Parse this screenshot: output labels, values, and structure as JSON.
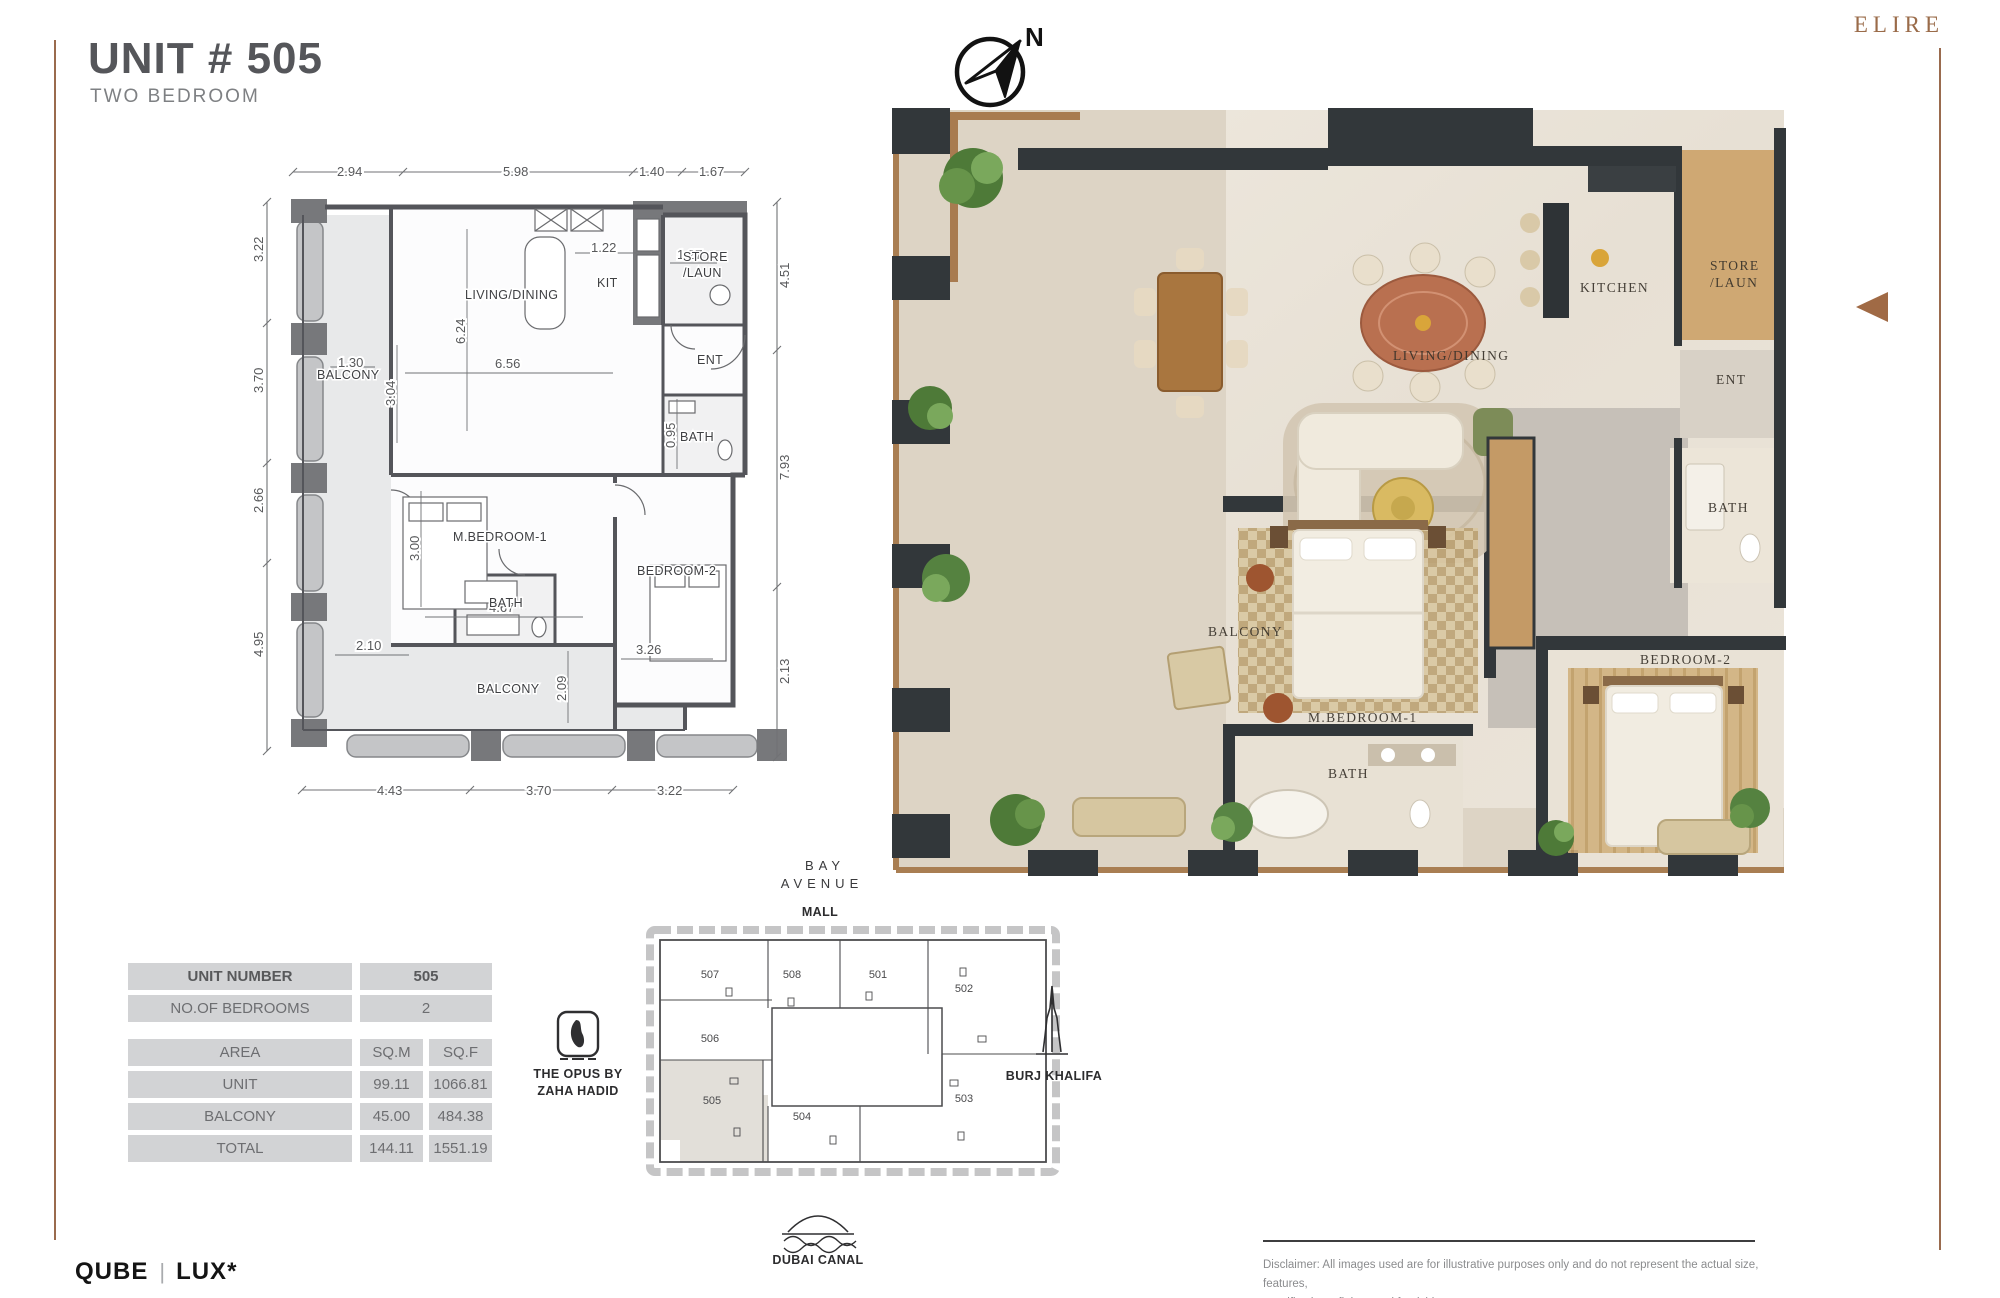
{
  "header": {
    "title": "UNIT # 505",
    "subtitle": "TWO BEDROOM",
    "brand": "ELIRE"
  },
  "compass": {
    "label": "N"
  },
  "plan": {
    "labels": {
      "balcony_top": "BALCONY",
      "living": "LIVING/DINING",
      "kit": "KIT",
      "store_l1": "STORE",
      "store_l2": "/LAUN",
      "ent": "ENT",
      "bath_top": "BATH",
      "mbed": "M.BEDROOM-1",
      "bed2": "BEDROOM-2",
      "bath_low": "BATH",
      "balcony_bottom": "BALCONY"
    },
    "dims": {
      "top": [
        "2.94",
        "5.98",
        "1.40",
        "1.67"
      ],
      "left": [
        "3.22",
        "3.70",
        "2.66",
        "4.95"
      ],
      "right": [
        "4.51",
        "7.93",
        "2.13"
      ],
      "bottom": [
        "4.43",
        "3.70",
        "3.22"
      ],
      "inner": {
        "d122": "1.22",
        "d127": "1.27",
        "d624": "6.24",
        "d130": "1.30",
        "d656": "6.56",
        "d304": "3.04",
        "d300": "3.00",
        "d467": "4.67",
        "d095": "0.95",
        "d210": "2.10",
        "d326": "3.26",
        "d209": "2.09"
      }
    }
  },
  "render": {
    "labels": {
      "living": "LIVING/DINING",
      "kitchen": "KITCHEN",
      "store1": "STORE",
      "store2": "/LAUN",
      "ent": "ENT",
      "bath_r": "BATH",
      "balcony": "BALCONY",
      "mbed": "M.BEDROOM-1",
      "bath_b": "BATH",
      "bed2": "BEDROOM-2"
    }
  },
  "unit_table": {
    "rows": [
      {
        "label": "UNIT NUMBER",
        "value": "505"
      },
      {
        "label": "NO.OF BEDROOMS",
        "value": "2"
      }
    ],
    "area": {
      "label": "AREA",
      "sqm": "SQ.M",
      "sqf": "SQ.F"
    },
    "area_rows": [
      {
        "label": "UNIT",
        "sqm": "99.11",
        "sqf": "1066.81"
      },
      {
        "label": "BALCONY",
        "sqm": "45.00",
        "sqf": "484.38"
      },
      {
        "label": "TOTAL",
        "sqm": "144.11",
        "sqf": "1551.19"
      }
    ]
  },
  "key_plan": {
    "units": {
      "u507": "507",
      "u508": "508",
      "u501": "501",
      "u502": "502",
      "u506": "506",
      "u505": "505",
      "u504": "504",
      "u503": "503"
    },
    "highlighted_unit": "505",
    "mall1": "BAY",
    "mall2": "AVENUE",
    "mall3": "MALL",
    "opus1": "THE OPUS BY",
    "opus2": "ZAHA HADID",
    "burj": "BURJ KHALIFA",
    "canal": "DUBAI CANAL"
  },
  "footer": {
    "brand1": "QUBE",
    "sep": "|",
    "brand2": "LUX*",
    "disclaimer1": "Disclaimer: All images used are for illustrative purposes only and do not represent the actual size, features,",
    "disclaimer2": "specifications, fittings and furnishings."
  },
  "colors": {
    "accent_brown": "#9a6b4e",
    "arrow_brown": "#a06a45",
    "plan_gray": "#55565a",
    "table_gray": "#d2d3d5",
    "wall_dark": "#32373a",
    "wood": "#a9763f"
  }
}
